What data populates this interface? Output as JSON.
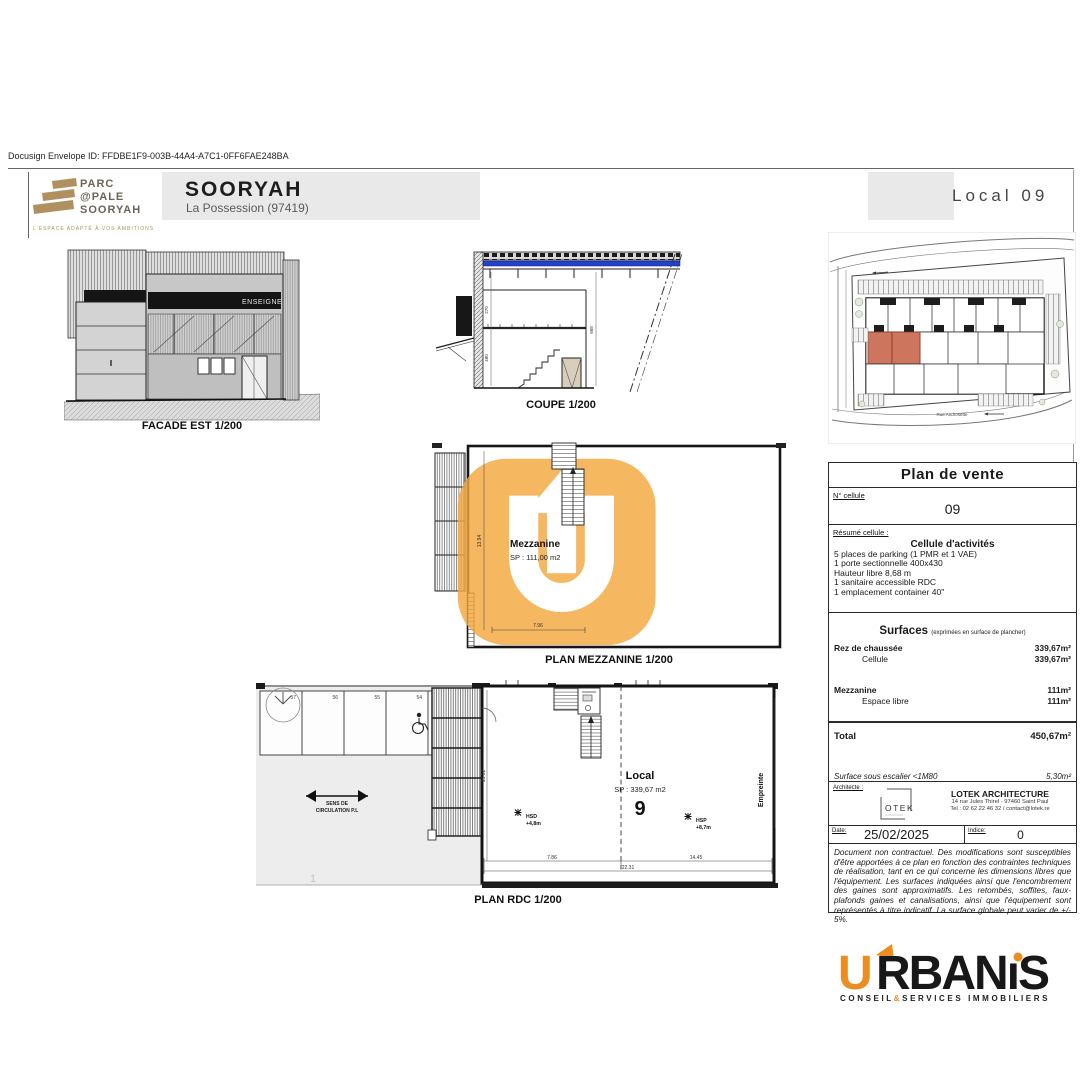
{
  "page": {
    "docusign": "Docusign Envelope ID: FFDBE1F9-003B-44A4-A7C1-0FF6FAE248BA"
  },
  "header": {
    "logo_line1": "PARC",
    "logo_line2": "@PALE",
    "logo_line3": "SOORYAH",
    "logo_tagline": "L'ESPACE ADAPTÉ À VOS AMBITIONS",
    "title": "SOORYAH",
    "subtitle": "La Possession (97419)",
    "local_ref": "Local 09"
  },
  "facade": {
    "label": "FACADE EST 1/200",
    "sign": "ENSEIGNE"
  },
  "coupe": {
    "label": "COUPE 1/200",
    "dim1": "270",
    "dim2": "480",
    "dim3": "868"
  },
  "mezzanine": {
    "label": "PLAN MEZZANINE 1/200",
    "room": "Mezzanine",
    "sp": "SP : 111,00 m2",
    "dim_w": "7.96",
    "dim_h": "13.94"
  },
  "rdc": {
    "label": "PLAN RDC 1/200",
    "room": "Local",
    "sp": "SP : 339,67 m2",
    "num": "9",
    "hsd_label": "HSD",
    "hsd_value": "+4,8m",
    "hsp_label": "HSP",
    "hsp_value": "+8,7m",
    "empreinte": "Empreinte",
    "sens_line1": "SENS DE",
    "sens_line2": "CIRCULATION P.L",
    "parking_numbers": [
      "57",
      "56",
      "55",
      "54"
    ],
    "dim_left": "7.86",
    "dim_right": "14.45",
    "dim_total": "22.31",
    "dim_height": "15.02",
    "page_mark": "1"
  },
  "site_plan": {
    "street_bottom": "Rue Androsette"
  },
  "panel": {
    "title": "Plan de vente",
    "cell_label": "N° cellule",
    "cell_value": "09",
    "resume_label": "Résumé cellule :",
    "resume_title": "Cellule d'activités",
    "resume_lines": [
      "5 places de parking (1 PMR et 1 VAE)",
      "1 porte sectionnelle 400x430",
      "Hauteur libre 8,68 m",
      "1 sanitaire accessible RDC",
      "1 emplacement container 40\""
    ],
    "surfaces_title": "Surfaces",
    "surfaces_note": "(exprimées en surface de plancher)",
    "rows": [
      {
        "label": "Rez de chaussée",
        "value": "339,67m²"
      },
      {
        "label": "Cellule",
        "value": "339,67m²"
      },
      {
        "label": "Mezzanine",
        "value": "111m²"
      },
      {
        "label": "Espace libre",
        "value": "111m²"
      }
    ],
    "total_label": "Total",
    "total_value": "450,67m²",
    "escalier_label": "Surface sous escalier  <1M80",
    "escalier_value": "5,30m²",
    "architecte_label": "Architecte :",
    "lotek_logo": "OTEK",
    "arch_name": "LOTEK ARCHITECTURE",
    "arch_addr": "14 rue Jules Thirel - 97460 Saint Paul",
    "arch_tel": "Tel : 02 62 22 46 32 / contact@lotek.re",
    "date_label": "Date:",
    "date_value": "25/02/2025",
    "indice_label": "Indice:",
    "indice_value": "0",
    "disclaimer": "Document non contractuel. Des modifications sont susceptibles d'être apportées à ce plan en fonction des contraintes techniques de réalisation, tant en ce qui concerne les dimensions libres que l'équipement. Les surfaces indiquées ainsi que l'encombrement des gaines sont approximatifs. Les retombés, soffites, faux-plafonds gaines et canalisations, ainsi que l'équipement sont représentés à titre indicatif. La surface globale peut varier de +/- 5%."
  },
  "footer": {
    "brand_u": "U",
    "brand_rest": "RBAN",
    "brand_i": "ı",
    "brand_s": "S",
    "tagline_1": "CONSEIL",
    "tagline_amp": "&",
    "tagline_2": "SERVICES IMMOBILIERS"
  },
  "colors": {
    "accent_orange": "#ee8d1f",
    "watermark_orange": "#f3a83e",
    "highlight_red": "#c96a50",
    "roof_blue": "#2440cc",
    "logo_tan": "#b1905f"
  }
}
